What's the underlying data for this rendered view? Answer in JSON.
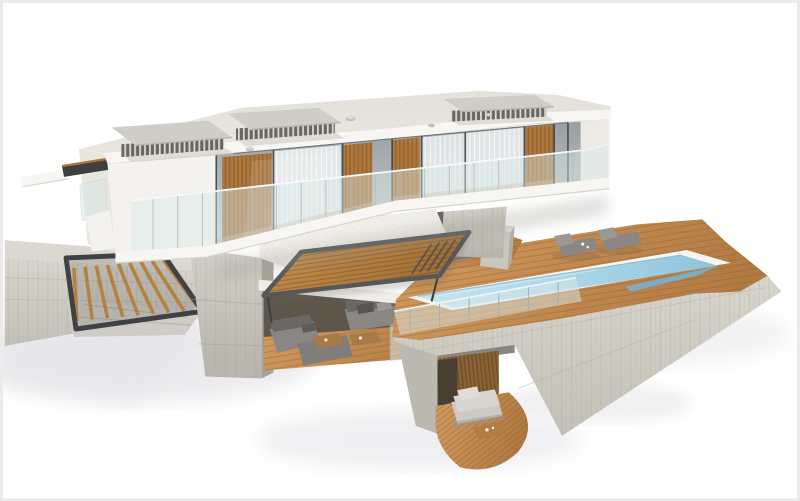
{
  "scene": {
    "kind": "3d-architectural-render",
    "subject": "modern-two-storey-villa-with-pool",
    "view": "aerial-three-quarter",
    "background": "#ffffff"
  },
  "colors": {
    "frame": "#ebebeb",
    "white-wall": "#f4f2ee",
    "white-band": "#f8f6f2",
    "wall-shade": "#e9e6e0",
    "roof": "#e8e6df",
    "glass-top": "#99a0a4",
    "glass-bottom": "#c6ccce",
    "balustrade-glass": "#d9e8e7",
    "facade-slat": "#ae783e",
    "curtain": "#eef1f2",
    "concrete-light": "#d8d5cd",
    "concrete-mid": "#c3c0b7",
    "concrete-dark": "#aca99f",
    "deck-light": "#d19b61",
    "deck-dark": "#b17a42",
    "pergola-light": "#c9914f",
    "pergola-dark": "#a06d35",
    "metal-dark": "#3f4144",
    "stair-wood": "#b5813f",
    "water-light": "#c6e5f2",
    "water-mid": "#9ccde2",
    "water-deep": "#78b1d0",
    "pool-rim": "#f5f5f2",
    "sofa-gray": "#8a8683",
    "sofa-dark": "#6b6764",
    "daybed": "#cdcac5",
    "slatwall": "#8a6234",
    "interior-dark": "#5f564b",
    "shadow-soft": "#e4e4e8"
  },
  "objects": [
    "flat-roof",
    "rooftop-skylight",
    "roof-vent",
    "glass-facade",
    "wood-slat-panel",
    "curtains",
    "glass-balustrade",
    "cantilevered-upper-floor",
    "concrete-podium",
    "support-column",
    "louvered-pergola",
    "outdoor-lounge-sofas",
    "coffee-table",
    "swimming-pool",
    "pool-step-shelf",
    "wooden-pool-deck",
    "glass-pool-fence",
    "sun-loungers",
    "outdoor-staircase",
    "retaining-wall",
    "sunken-patio",
    "daybed",
    "curved-wood-deck-ribbon"
  ]
}
